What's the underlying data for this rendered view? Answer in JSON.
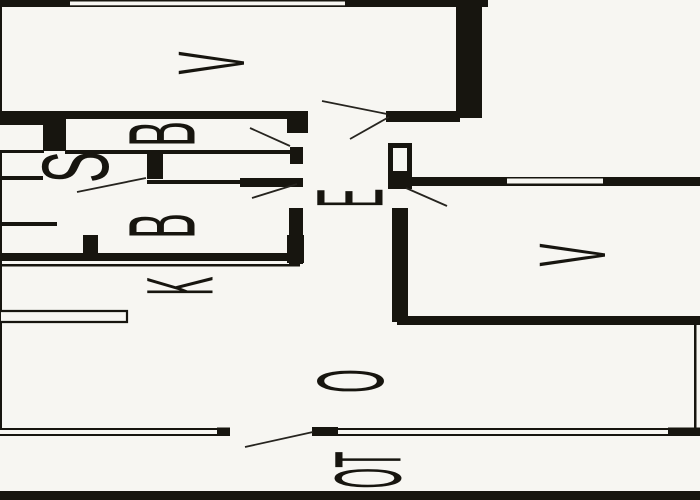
{
  "plan": {
    "type": "floor-plan",
    "orientation": "rotated-90",
    "colors": {
      "wall": "#17150f",
      "floor": "#f7f6f2",
      "line": "#26241f"
    },
    "rooms": [
      {
        "id": "v1",
        "label": "V"
      },
      {
        "id": "b1",
        "label": "B"
      },
      {
        "id": "s",
        "label": "S"
      },
      {
        "id": "b2",
        "label": "B"
      },
      {
        "id": "k",
        "label": "K"
      },
      {
        "id": "e",
        "label": "E"
      },
      {
        "id": "o",
        "label": "O"
      },
      {
        "id": "v2",
        "label": "V"
      },
      {
        "id": "ot",
        "label": "OT"
      }
    ]
  }
}
